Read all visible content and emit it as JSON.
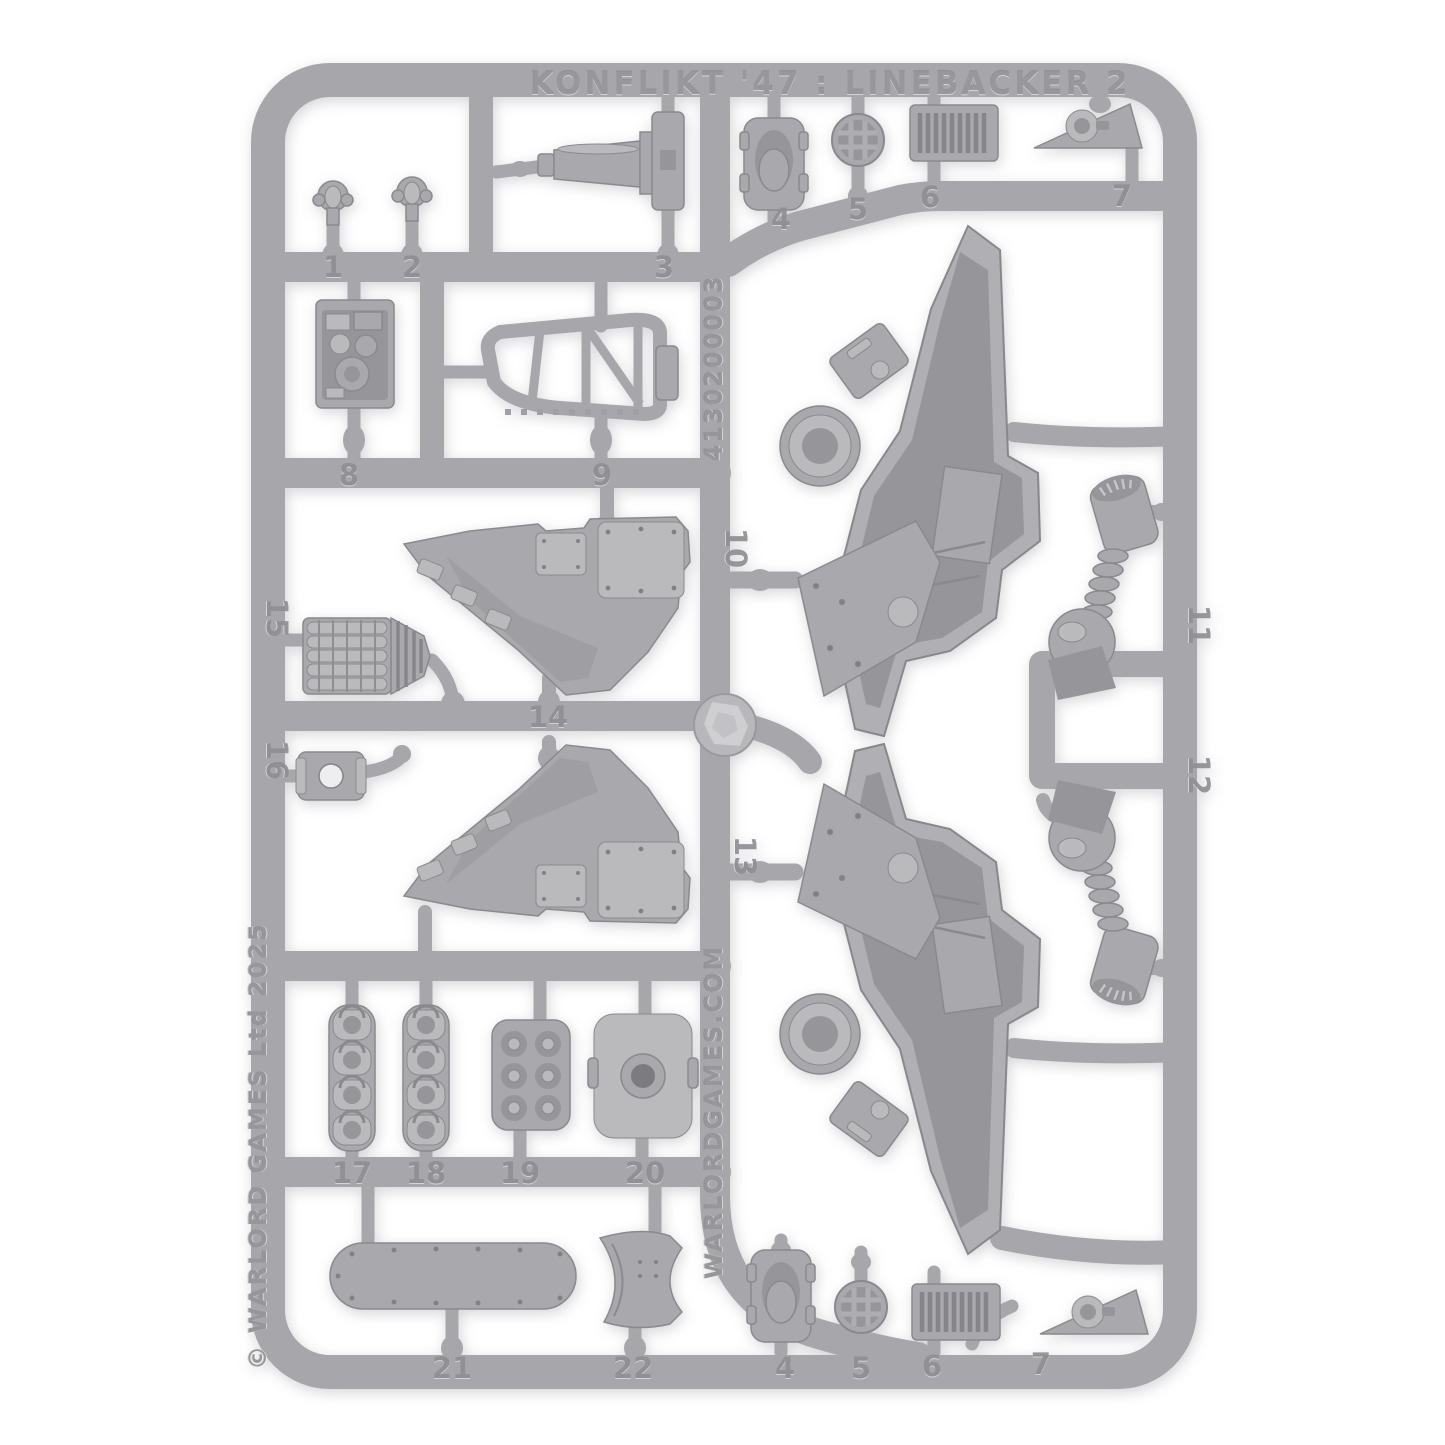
{
  "photo": {
    "type": "product photograph of a grey plastic model kit sprue on white background",
    "background_color": "#ffffff",
    "plastic_color": "#a7a7ab"
  },
  "sprue": {
    "title": "KONFLIKT '47 : LINEBACKER 2",
    "sku_vertical": "4130200003",
    "website_vertical": "WARLORDGAMES.COM",
    "copyright_vertical": "© WARLORD GAMES Ltd 2025",
    "part_labels": [
      "1",
      "2",
      "3",
      "4",
      "5",
      "6",
      "7",
      "8",
      "9",
      "10",
      "11",
      "12",
      "13",
      "14",
      "15",
      "16",
      "17",
      "18",
      "19",
      "20",
      "21",
      "22"
    ],
    "bottom_duplicate_labels": [
      "4",
      "5",
      "6",
      "7"
    ]
  }
}
